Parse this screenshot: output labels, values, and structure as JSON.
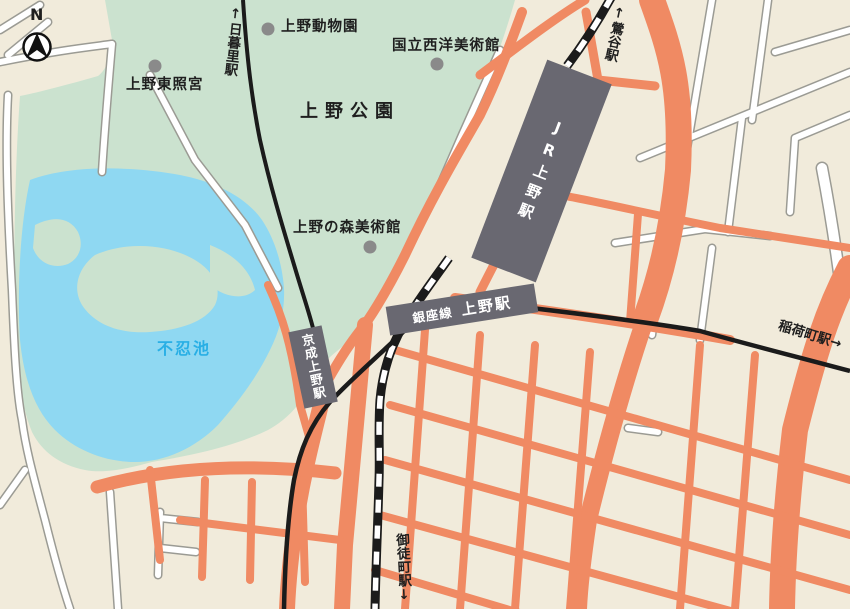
{
  "compass": {
    "label": "N"
  },
  "park": {
    "name": "上野公園"
  },
  "pond": {
    "name": "不忍池"
  },
  "pois": [
    {
      "name": "上野動物園"
    },
    {
      "name": "国立西洋美術館"
    },
    {
      "name": "上野東照宮"
    },
    {
      "name": "上野の森美術館"
    }
  ],
  "stations": {
    "jr_ueno": "JR上野駅",
    "keisei_ueno": "京成上野駅",
    "ginza_line": "銀座線",
    "ginza_station": "上野駅",
    "nippori": "↑日暮里駅",
    "uguisudani": "↑鶯谷駅",
    "inaricho": "稲荷町駅→",
    "okachimachi": "御徒町駅↓"
  },
  "colors": {
    "background": "#F1EBDB",
    "park_green": "#CBE2CF",
    "pond_blue": "#8FD8F2",
    "main_road_orange": "#F08A63",
    "road_casing_gray": "#9B9B94",
    "station_gray": "#696871",
    "rail_black": "#1B1B1B",
    "poi_dot_gray": "#8A8A8A",
    "pond_label_blue": "#29AFE5"
  }
}
